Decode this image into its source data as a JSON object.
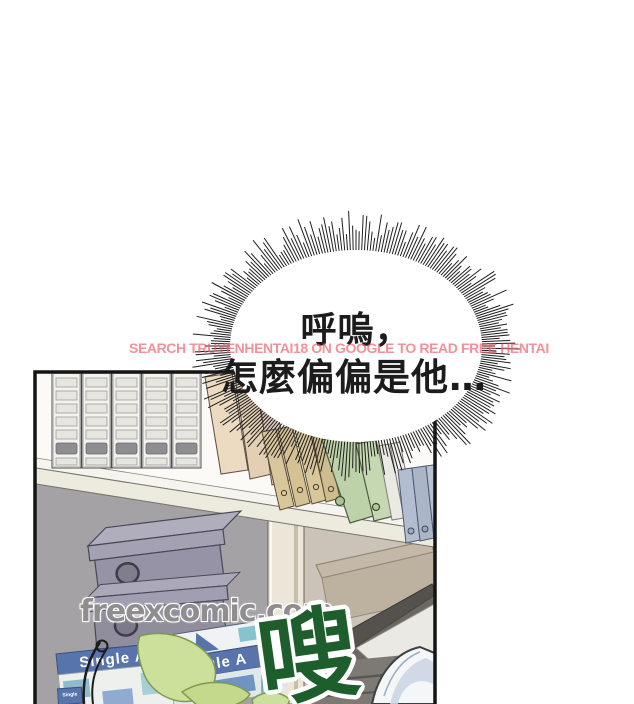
{
  "page": {
    "background": "#ffffff"
  },
  "bubble": {
    "line1": "呼嗚，",
    "line2": "怎麼偏偏是他…",
    "fill": "#ffffff",
    "text_color": "#1c1c1c"
  },
  "watermark_banner": {
    "text": "SEARCH TRUYENHENTAI18 ON GOOGLE TO READ FREE HENTAI",
    "color": "#e95f69"
  },
  "watermark_site": {
    "text": "freexcomic.com",
    "color": "#8f8d8d"
  },
  "sfx": {
    "text": "嗖",
    "color": "#1e5e2c",
    "outline": "#ffffff"
  },
  "shelf": {
    "paper_box_front_label": "Single A",
    "paper_box_rear_label": "ingle A",
    "paper_box_small_label": "Single",
    "paper_box_blue": "#5874ac",
    "storage_box_gray": "#9593a5",
    "leaf_green": "#ccdf9b"
  }
}
